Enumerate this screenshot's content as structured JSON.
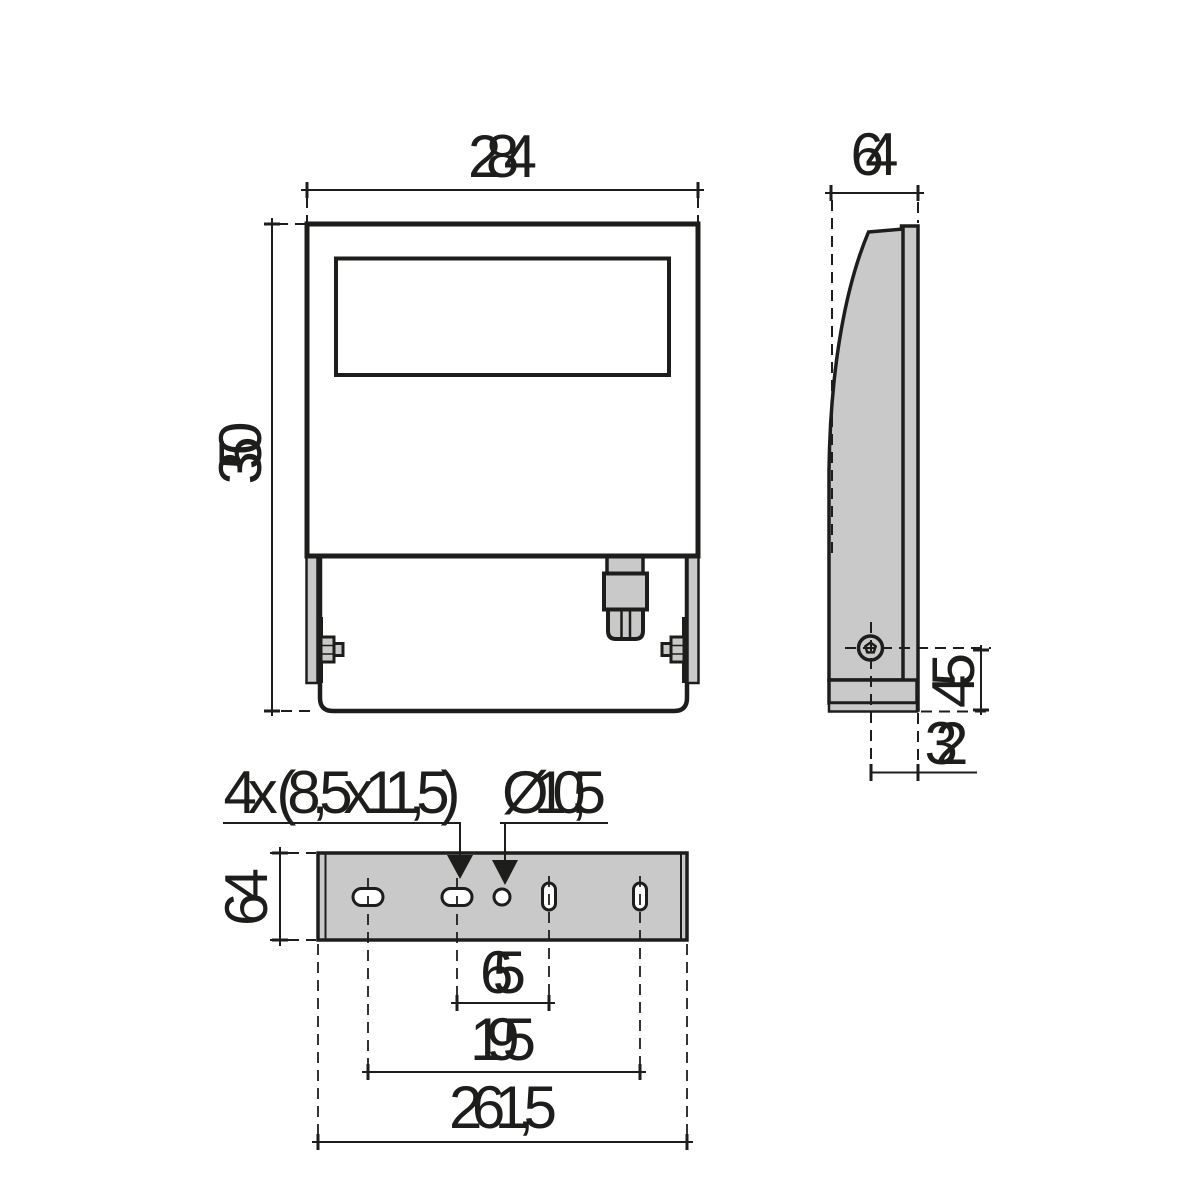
{
  "drawing": {
    "type": "dimensional-drawing",
    "subject": "floodlight-luminaire-three-views",
    "units_style": "millimetres-comma-decimal"
  },
  "colors": {
    "line": "#1d1d1b",
    "part_fill": "#c9c9c9",
    "background": "#ffffff"
  },
  "views": {
    "front": {
      "width": "284",
      "height": "350"
    },
    "side": {
      "depth": "64",
      "bolt_height": "45",
      "bolt_offset": "32"
    },
    "bottom": {
      "depth": "64",
      "slots_note": "4x (8,5x11,5)",
      "hole_note": "Ø10,5",
      "pitch_inner": "65",
      "pitch_mid": "195",
      "pitch_outer": "261,5"
    }
  }
}
